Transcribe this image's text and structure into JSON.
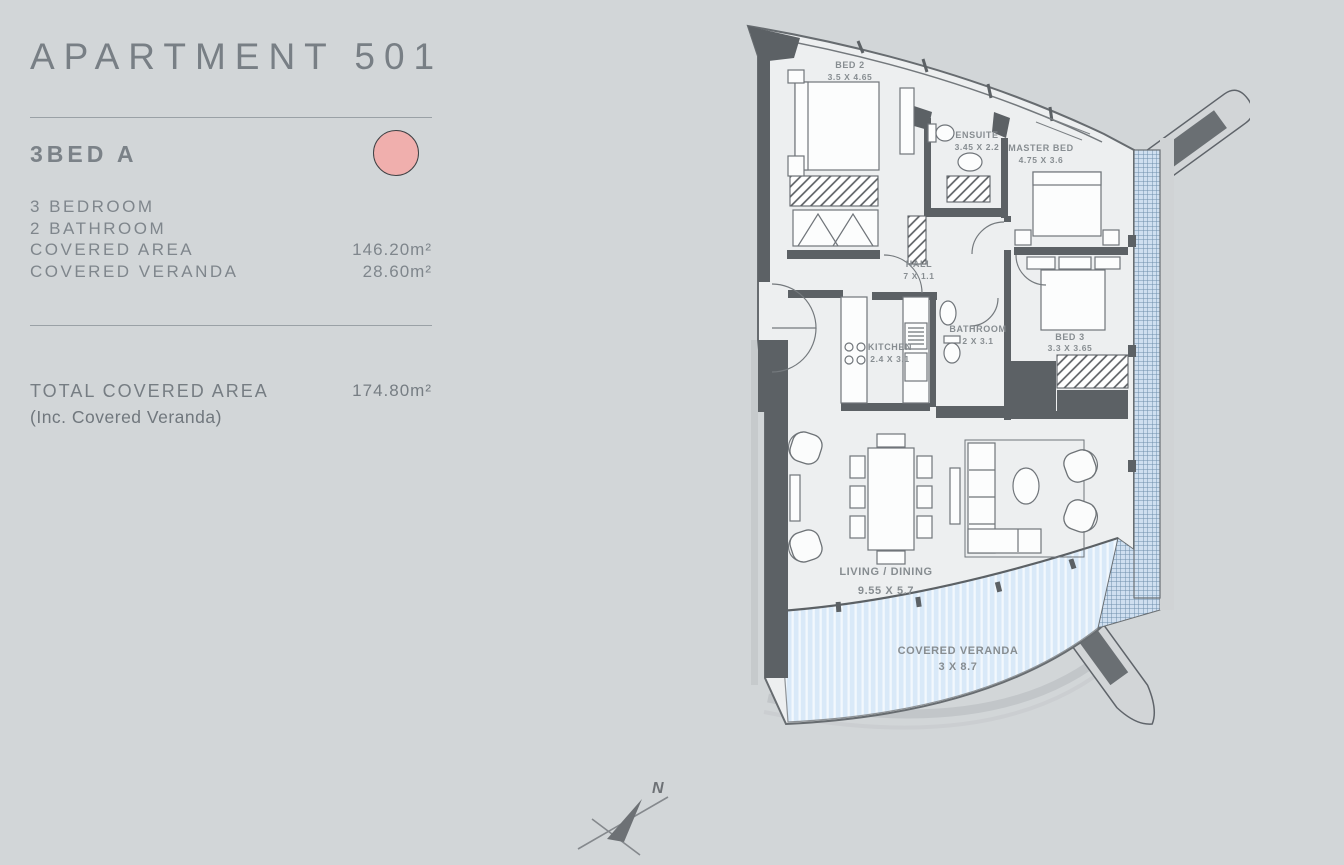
{
  "panel": {
    "title": "APARTMENT 501",
    "unit": {
      "type": "3BED A",
      "color": "#f0afad"
    },
    "specs": [
      {
        "label": "3 BEDROOM",
        "value": ""
      },
      {
        "label": "2 BATHROOM",
        "value": ""
      },
      {
        "label": "COVERED AREA",
        "value": "146.20m²"
      },
      {
        "label": "COVERED VERANDA",
        "value": "28.60m²"
      }
    ],
    "total": {
      "label": "TOTAL COVERED AREA",
      "value": "174.80m²",
      "note": "(Inc. Covered Veranda)"
    }
  },
  "plan": {
    "rooms": [
      {
        "name": "BED 2",
        "dims": "3.5 X 4.65"
      },
      {
        "name": "ENSUITE",
        "dims": "3.45 X 2.2"
      },
      {
        "name": "MASTER BED",
        "dims": "4.75 X 3.6"
      },
      {
        "name": "HALL",
        "dims": "7 X 1.1"
      },
      {
        "name": "KITCHEN",
        "dims": "2.4 X 3.1"
      },
      {
        "name": "BATHROOM",
        "dims": "2 X 3.1"
      },
      {
        "name": "BED 3",
        "dims": "3.3 X 3.65"
      },
      {
        "name": "LIVING / DINING",
        "dims": "9.55 X 5.7"
      },
      {
        "name": "COVERED VERANDA",
        "dims": "3 X 8.7"
      }
    ],
    "compass": {
      "label": "N"
    },
    "colors": {
      "wall": "#5c6165",
      "floor": "#edeff0",
      "veranda_blue": "#d9e9f8",
      "glazing_blue": "#cfdff0"
    }
  }
}
